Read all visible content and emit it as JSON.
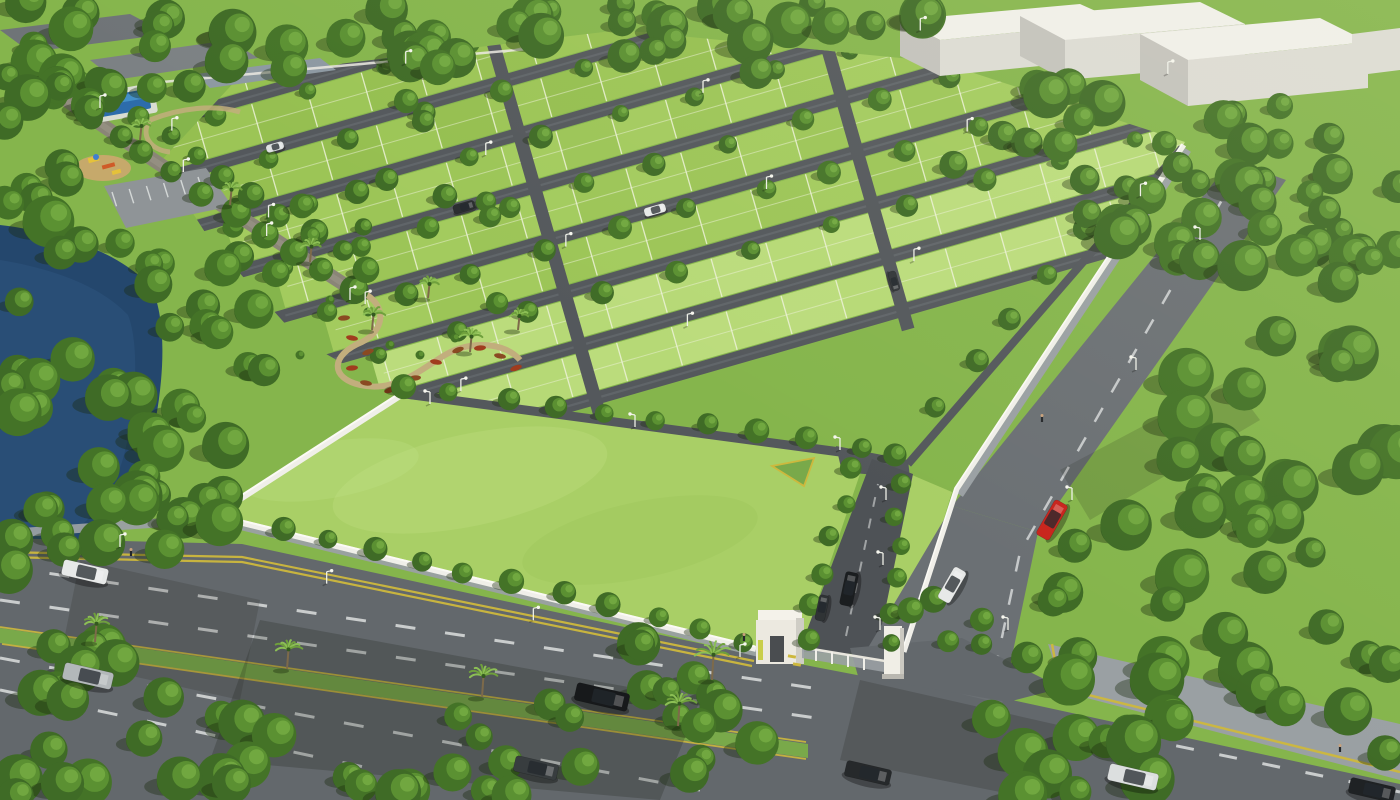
{
  "scene": {
    "label": "aerial-render-plotted-land-development"
  },
  "seed": 12,
  "colors": {
    "base": "#85b54c",
    "plotA": "#a3cb5e",
    "plotB": "#95bf50",
    "plotC": "#b1d56e",
    "plotFront": "#bbdc7c",
    "roadIn": "#54585c",
    "roadInLight": "#6d7276",
    "gridLine": "#edf2d8",
    "lawn": "#a9cf66",
    "lawnHi": "#c2e083",
    "pathTan": "#c2ae7d",
    "parking": "#8f9497",
    "pool": "#2d6cab",
    "poolLight": "#4f9fd6",
    "poolDeck": "#d9ddd2",
    "playBase": "#c6a96b",
    "playYellow": "#e5c23a",
    "playRed": "#cf5b28",
    "playBlue": "#3f7fd0",
    "flowerA": "#8a4a22",
    "flowerB": "#a03c1e",
    "hwy": "#63686c",
    "sidewalk": "#9aa0a3",
    "median": "#79a94a",
    "laneYellow": "#cdb83d",
    "dashWhite": "#e3e6e6",
    "wall": "#f0efe9",
    "wallHi": "#fbfaf5",
    "gateWhite": "#ece9e0",
    "gateDark": "#4a4d50",
    "gateAccent": "#c9ce4a",
    "gatePanel": "#9aa0a4",
    "signBlue": "#3a6db2",
    "treeDark": "#33591f",
    "treeMid": "#447327",
    "treeMid2": "#3f6b26",
    "treeLight": "#5d9233",
    "treeHi": "#76ab43",
    "palm": "#6fa03c",
    "palmLight": "#8cbf55",
    "trunk": "#7d6a4a",
    "lake": "#24476d",
    "lakeHi": "#2e547e",
    "bldRoof": "#f0efe9",
    "bldFront": "#dcdbd4",
    "bldSide": "#c3c2bc",
    "greyRoofA": "#6f7477",
    "greyRoofB": "#7c8184",
    "pavilion": "#8d99a2",
    "shadowTree": "rgba(25,42,14,0.38)",
    "shadowRoad": "rgba(28,32,26,0.24)",
    "carWhite": "#e7e9e8",
    "carSilver": "#b3b8ba",
    "carRed": "#c8241d",
    "pole": "#eef0e8",
    "skin": "#c9a17b",
    "figure": "#24272a"
  },
  "layout": {
    "width": 1400,
    "height": 800,
    "origin": {
      "x": 150,
      "y": 370
    },
    "angleDeg": 16,
    "roads": [
      -290,
      -235,
      -180,
      -125,
      -70,
      -15,
      40,
      95,
      150
    ],
    "roadWidth": 13,
    "plotStep": 57,
    "gridEndX": 1100,
    "grid": {
      "x0": -9.3,
      "yRef": -294,
      "slope": 0.625
    },
    "cross": [
      420,
      740
    ],
    "parking": {
      "a": [
        112,
        192
      ],
      "b": [
        198,
        177
      ],
      "len": 15,
      "n": 6
    }
  },
  "belts": [
    {
      "local": true,
      "x1": 18,
      "y1": -280,
      "x2": 1085,
      "y2": -280,
      "n": 13,
      "r1": 8,
      "r2": 12
    },
    {
      "local": true,
      "x1": 52,
      "y1": -225,
      "x2": 1085,
      "y2": -225,
      "n": 13,
      "r1": 8,
      "r2": 12
    },
    {
      "local": true,
      "x1": 87,
      "y1": -170,
      "x2": 1085,
      "y2": -170,
      "n": 13,
      "r1": 8,
      "r2": 12
    },
    {
      "local": true,
      "x1": 121,
      "y1": -115,
      "x2": 1085,
      "y2": -115,
      "n": 13,
      "r1": 8,
      "r2": 12
    },
    {
      "local": true,
      "x1": 156,
      "y1": -60,
      "x2": 1085,
      "y2": -60,
      "n": 13,
      "r1": 8,
      "r2": 12
    },
    {
      "local": true,
      "x1": 190,
      "y1": -5,
      "x2": 1085,
      "y2": -5,
      "n": 13,
      "r1": 8,
      "r2": 12
    },
    {
      "local": true,
      "x1": 224,
      "y1": 50,
      "x2": 1085,
      "y2": 50,
      "n": 12,
      "r1": 8,
      "r2": 12
    },
    {
      "x1": 58,
      "y1": 96,
      "x2": 350,
      "y2": 292,
      "n": 11,
      "r1": 10,
      "r2": 15
    },
    {
      "x1": 82,
      "y1": 80,
      "x2": 368,
      "y2": 272,
      "n": 11,
      "r1": 9,
      "r2": 14
    },
    {
      "x1": 232,
      "y1": 516,
      "x2": 748,
      "y2": 640,
      "n": 12,
      "r1": 9,
      "r2": 13
    },
    {
      "x1": 402,
      "y1": 386,
      "x2": 862,
      "y2": 446,
      "n": 10,
      "r1": 9,
      "r2": 13
    },
    {
      "x1": 852,
      "y1": 470,
      "x2": 806,
      "y2": 640,
      "n": 6,
      "r1": 9,
      "r2": 12
    },
    {
      "x1": 899,
      "y1": 482,
      "x2": 893,
      "y2": 645,
      "n": 6,
      "r1": 8,
      "r2": 11
    },
    {
      "x1": 896,
      "y1": 452,
      "x2": 1166,
      "y2": 142,
      "n": 8,
      "r1": 9,
      "r2": 13
    }
  ],
  "scatters": [
    {
      "poly": [
        [
          0,
          0
        ],
        [
          945,
          0
        ],
        [
          945,
          86
        ],
        [
          600,
          64
        ],
        [
          240,
          86
        ],
        [
          0,
          128
        ]
      ],
      "n": 55,
      "r1": 13,
      "r2": 24
    },
    {
      "poly": [
        [
          0,
          108
        ],
        [
          95,
          104
        ],
        [
          70,
          210
        ],
        [
          0,
          225
        ]
      ],
      "n": 8,
      "r1": 12,
      "r2": 18
    },
    {
      "poly": [
        [
          140,
          250
        ],
        [
          265,
          215
        ],
        [
          320,
          305
        ],
        [
          240,
          345
        ],
        [
          155,
          305
        ]
      ],
      "n": 10,
      "r1": 13,
      "r2": 20
    },
    {
      "poly": [
        [
          0,
          210
        ],
        [
          120,
          235
        ],
        [
          230,
          290
        ],
        [
          290,
          390
        ],
        [
          245,
          470
        ],
        [
          215,
          545
        ],
        [
          120,
          590
        ],
        [
          0,
          612
        ]
      ],
      "n": 42,
      "r1": 14,
      "r2": 26
    },
    {
      "poly": [
        [
          948,
          66
        ],
        [
          1400,
          112
        ],
        [
          1400,
          290
        ],
        [
          1170,
          262
        ],
        [
          948,
          180
        ]
      ],
      "n": 45,
      "r1": 13,
      "r2": 24
    },
    {
      "poly": [
        [
          1268,
          190
        ],
        [
          1400,
          248
        ],
        [
          1400,
          800
        ],
        [
          1020,
          800
        ],
        [
          962,
          692
        ],
        [
          1140,
          432
        ],
        [
          1222,
          300
        ]
      ],
      "n": 58,
      "r1": 15,
      "r2": 28
    },
    {
      "poly": [
        [
          0,
          628
        ],
        [
          290,
          676
        ],
        [
          450,
          800
        ],
        [
          0,
          800
        ]
      ],
      "n": 26,
      "r1": 15,
      "r2": 26
    },
    {
      "poly": [
        [
          452,
          716
        ],
        [
          560,
          700
        ],
        [
          626,
          762
        ],
        [
          520,
          800
        ],
        [
          448,
          800
        ]
      ],
      "n": 9,
      "r1": 13,
      "r2": 20
    },
    {
      "poly": [
        [
          636,
          642
        ],
        [
          758,
          662
        ],
        [
          780,
          800
        ],
        [
          616,
          800
        ]
      ],
      "n": 12,
      "r1": 14,
      "r2": 22
    },
    {
      "poly": [
        [
          908,
          588
        ],
        [
          1000,
          612
        ],
        [
          986,
          678
        ],
        [
          916,
          660
        ]
      ],
      "n": 5,
      "r1": 10,
      "r2": 15
    },
    {
      "poly": [
        [
          220,
          120
        ],
        [
          420,
          96
        ],
        [
          520,
          170
        ],
        [
          560,
          300
        ],
        [
          420,
          330
        ],
        [
          260,
          220
        ]
      ],
      "n": 10,
      "r1": 8,
      "r2": 13
    }
  ],
  "palms": [
    {
      "x": 95,
      "y": 642,
      "s": 13
    },
    {
      "x": 287,
      "y": 669,
      "s": 14
    },
    {
      "x": 482,
      "y": 697,
      "s": 15
    },
    {
      "x": 678,
      "y": 726,
      "s": 16
    },
    {
      "x": 712,
      "y": 680,
      "s": 18
    },
    {
      "x": 372,
      "y": 330,
      "s": 11
    },
    {
      "x": 428,
      "y": 298,
      "s": 10
    },
    {
      "x": 470,
      "y": 352,
      "s": 11
    },
    {
      "x": 518,
      "y": 330,
      "s": 10
    },
    {
      "x": 140,
      "y": 140,
      "s": 10
    },
    {
      "x": 230,
      "y": 205,
      "s": 11
    },
    {
      "x": 310,
      "y": 262,
      "s": 11
    }
  ],
  "cars": [
    {
      "x": 85,
      "y": 572,
      "rot": 13,
      "w": 46,
      "h": 16,
      "c": "#e7e9e8"
    },
    {
      "x": 88,
      "y": 676,
      "rot": 13,
      "w": 50,
      "h": 17,
      "c": "#b3b8ba"
    },
    {
      "x": 602,
      "y": 697,
      "rot": 13,
      "w": 54,
      "h": 18,
      "c": "#17191b"
    },
    {
      "x": 536,
      "y": 768,
      "rot": 13,
      "w": 44,
      "h": 16,
      "c": "#383d3f"
    },
    {
      "x": 868,
      "y": 773,
      "rot": 13,
      "w": 46,
      "h": 16,
      "c": "#26292b"
    },
    {
      "x": 1133,
      "y": 777,
      "rot": 13,
      "w": 50,
      "h": 17,
      "c": "#dcdfdf"
    },
    {
      "x": 1372,
      "y": 790,
      "rot": 13,
      "w": 46,
      "h": 16,
      "c": "#1f2224"
    },
    {
      "x": 1052,
      "y": 520,
      "rot": -60,
      "w": 40,
      "h": 15,
      "c": "#c8241d"
    },
    {
      "x": 952,
      "y": 585,
      "rot": -60,
      "w": 36,
      "h": 14,
      "c": "#e7e9e8"
    },
    {
      "x": 849,
      "y": 589,
      "rot": -78,
      "w": 34,
      "h": 13,
      "c": "#1b1e20"
    },
    {
      "x": 822,
      "y": 608,
      "rot": -78,
      "w": 26,
      "h": 10,
      "c": "#2f3335"
    },
    {
      "x": 655,
      "y": 210,
      "rot": -16,
      "w": 22,
      "h": 9,
      "c": "#e7e9e8"
    },
    {
      "x": 464,
      "y": 207,
      "rot": -16,
      "w": 22,
      "h": 9,
      "c": "#2b2e30"
    },
    {
      "x": 275,
      "y": 147,
      "rot": -16,
      "w": 18,
      "h": 8,
      "c": "#dfe2e2"
    },
    {
      "x": 894,
      "y": 281,
      "rot": 74,
      "w": 20,
      "h": 8,
      "c": "#33373a"
    }
  ],
  "dashes": [
    {
      "pts": [
        [
          0,
          566
        ],
        [
          826,
          690
        ]
      ],
      "w": 3,
      "dash": 20,
      "gap": 30,
      "color": "#e3e6e6",
      "op": 0.8
    },
    {
      "pts": [
        [
          0,
          600
        ],
        [
          816,
          718
        ]
      ],
      "w": 3,
      "dash": 20,
      "gap": 30,
      "color": "#e3e6e6",
      "op": 0.8
    },
    {
      "pts": [
        [
          0,
          658
        ],
        [
          700,
          790
        ]
      ],
      "w": 3,
      "dash": 20,
      "gap": 30,
      "color": "#e3e6e6",
      "op": 0.8
    },
    {
      "pts": [
        [
          0,
          690
        ],
        [
          520,
          800
        ]
      ],
      "w": 3,
      "dash": 20,
      "gap": 30,
      "color": "#e3e6e6",
      "op": 0.8
    },
    {
      "pts": [
        [
          1090,
          728
        ],
        [
          1400,
          792
        ]
      ],
      "w": 3,
      "dash": 18,
      "gap": 26,
      "color": "#e3e6e6",
      "op": 0.8
    },
    {
      "pts": [
        [
          1238,
          172
        ],
        [
          1020,
          552
        ],
        [
          998,
          656
        ]
      ],
      "w": 2.5,
      "dash": 16,
      "gap": 18,
      "color": "#e3e6e6",
      "op": 0.75
    },
    {
      "pts": [
        [
          846,
          636
        ],
        [
          878,
          484
        ]
      ],
      "w": 2,
      "dash": 10,
      "gap": 12,
      "color": "#e3e6e6",
      "op": 0.55
    },
    {
      "pts": [
        [
          0,
          552
        ],
        [
          242,
          557
        ],
        [
          754,
          661
        ]
      ],
      "w": 2.2,
      "dash": 900,
      "gap": 0,
      "color": "#cdb83d",
      "op": 0.95
    },
    {
      "pts": [
        [
          0,
          557
        ],
        [
          242,
          562
        ],
        [
          752,
          666
        ]
      ],
      "w": 2.2,
      "dash": 900,
      "gap": 0,
      "color": "#cdb83d",
      "op": 0.95
    },
    {
      "pts": [
        [
          0,
          627
        ],
        [
          806,
          742
        ]
      ],
      "w": 1.8,
      "dash": 900,
      "gap": 0,
      "color": "#cdb83d",
      "op": 0.9
    },
    {
      "pts": [
        [
          2,
          644
        ],
        [
          806,
          759
        ]
      ],
      "w": 1.8,
      "dash": 900,
      "gap": 0,
      "color": "#cdb83d",
      "op": 0.9
    },
    {
      "pts": [
        [
          1052,
          644
        ],
        [
          1060,
          688
        ],
        [
          1400,
          772
        ]
      ],
      "w": 2.5,
      "dash": 900,
      "gap": 0,
      "color": "#cdb83d",
      "op": 0.95
    }
  ],
  "lights": [
    {
      "local": true,
      "x1": 87,
      "y1": -224,
      "x2": 1060,
      "y2": -224,
      "n": 5,
      "arm": 5
    },
    {
      "local": true,
      "x1": 156,
      "y1": -114,
      "x2": 1060,
      "y2": -114,
      "n": 5,
      "arm": 5
    },
    {
      "local": true,
      "x1": 225,
      "y1": -4,
      "x2": 1060,
      "y2": -4,
      "n": 5,
      "arm": 5
    },
    {
      "local": true,
      "x1": 293,
      "y1": 106,
      "x2": 1000,
      "y2": 106,
      "n": 4,
      "arm": 5
    },
    {
      "x1": 430,
      "y1": 404,
      "x2": 840,
      "y2": 450,
      "n": 3,
      "arm": -5
    },
    {
      "x1": 886,
      "y1": 500,
      "x2": 880,
      "y2": 630,
      "n": 3,
      "arm": -5
    },
    {
      "x1": 1008,
      "y1": 630,
      "x2": 1200,
      "y2": 240,
      "n": 4,
      "arm": -5
    },
    {
      "x1": 100,
      "y1": 108,
      "x2": 350,
      "y2": 300,
      "n": 4,
      "arm": 5
    },
    {
      "x1": 120,
      "y1": 547,
      "x2": 740,
      "y2": 657,
      "n": 4,
      "arm": 5
    }
  ],
  "people": [
    {
      "x": 131,
      "y": 556
    },
    {
      "x": 1042,
      "y": 422
    },
    {
      "x": 744,
      "y": 641
    },
    {
      "x": 1340,
      "y": 752
    }
  ],
  "garden": {
    "beds": [
      [
        358,
        300
      ],
      [
        344,
        318
      ],
      [
        352,
        338
      ],
      [
        368,
        352
      ],
      [
        352,
        368
      ],
      [
        366,
        383
      ],
      [
        390,
        390
      ],
      [
        415,
        378
      ],
      [
        436,
        362
      ],
      [
        458,
        350
      ],
      [
        480,
        348
      ],
      [
        500,
        356
      ],
      [
        516,
        368
      ]
    ],
    "shrubs": [
      [
        368,
        312
      ],
      [
        390,
        345
      ],
      [
        420,
        355
      ],
      [
        455,
        338
      ],
      [
        300,
        355
      ],
      [
        330,
        300
      ]
    ]
  },
  "gate": {
    "logo_icon": "developer-logo",
    "logo_color": "#3a6db2"
  }
}
